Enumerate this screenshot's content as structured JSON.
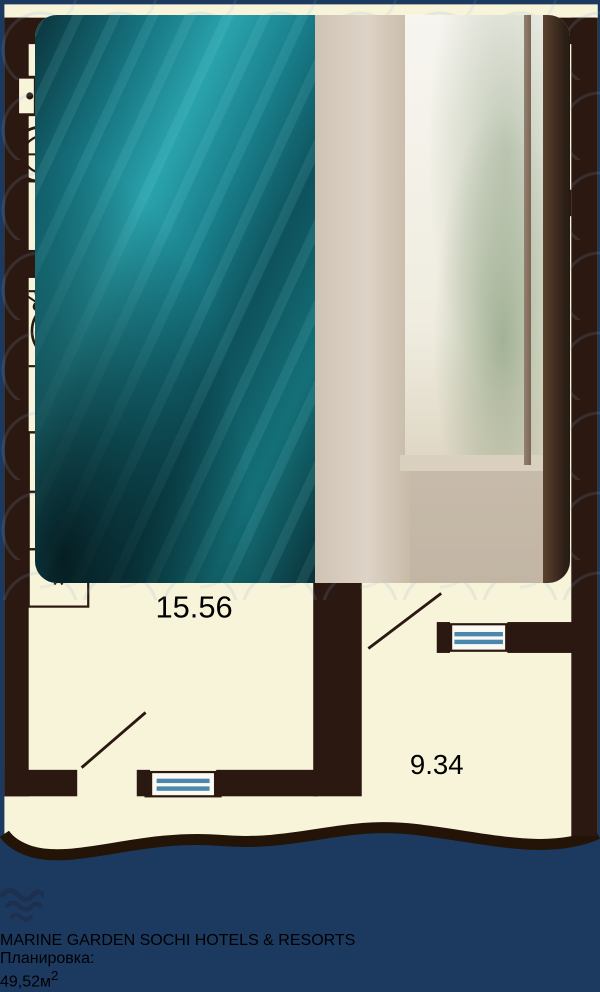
{
  "brand": {
    "line1": "MARINE",
    "line2": "GARDEN SOCHI",
    "tagline": "HOTELS & RESORTS"
  },
  "floorplan": {
    "badge": {
      "rooms": "2К",
      "total": "49.52",
      "living": "40.18"
    },
    "rooms": [
      {
        "id": "bathroom",
        "area": "3.57"
      },
      {
        "id": "hallway",
        "area": "7"
      },
      {
        "id": "bedroom",
        "area": "14.05"
      },
      {
        "id": "kitchen-living",
        "area": "15.56"
      },
      {
        "id": "terrace",
        "area": "9.34"
      }
    ]
  },
  "footer": {
    "label": "Планировка:",
    "number": "49,52",
    "unit": "м",
    "sup": "2"
  },
  "colors": {
    "frame_navy": "#1c3a5f",
    "plan_cream": "#f8f4da",
    "plan_wall": "#2b1810",
    "badge_navy": "#132e4c",
    "window_blue": "#4a86ad",
    "teal_wall": "#1d8a94",
    "chair_brown": "#9a5a2f"
  }
}
